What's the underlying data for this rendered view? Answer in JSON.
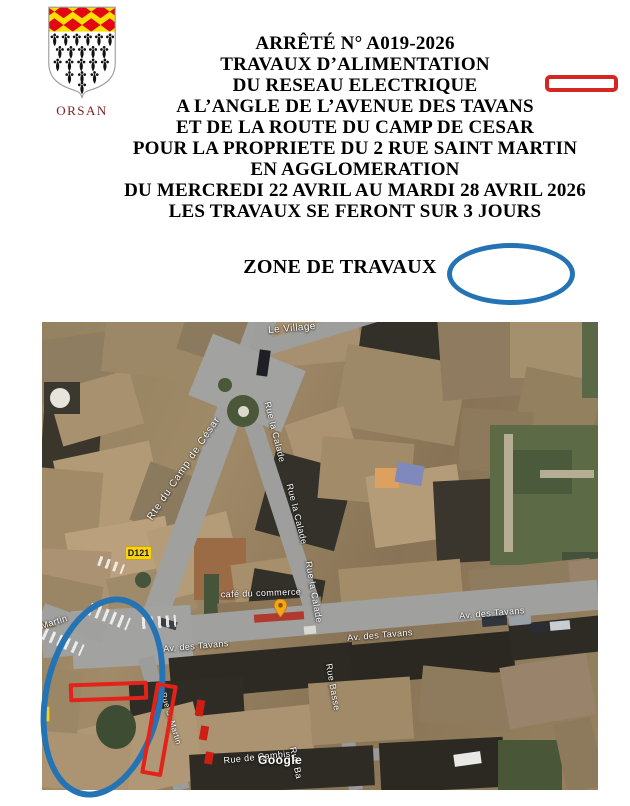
{
  "header": {
    "commune": "ORSAN",
    "title_lines": [
      "ARRÊTÉ N° A019-2026",
      "TRAVAUX D’ALIMENTATION",
      "DU RESEAU ELECTRIQUE",
      "A L’ANGLE DE L’AVENUE DES TAVANS",
      "ET DE LA ROUTE DU CAMP DE CESAR",
      "POUR LA PROPRIETE DU 2 RUE SAINT MARTIN",
      "EN AGGLOMERATION",
      "DU MERCREDI 22 AVRIL AU MARDI 28 AVRIL 2026",
      "LES TRAVAUX SE FERONT SUR 3 JOURS"
    ],
    "zone_label": "ZONE DE TRAVAUX"
  },
  "annotations": {
    "highlight_red": "#e32219",
    "highlight_blue": "#2473b5"
  },
  "map": {
    "road_badge": "D121",
    "attribution": "Google",
    "poi": {
      "name": "café du commerce",
      "pin_color": "#f7a61c"
    },
    "streets": {
      "le_village": "Le Village",
      "camp_de_cesar": "Rte du Camp de César",
      "calade": "Rue la Calade",
      "tavans": "Av. des Tavans",
      "basse": "Rue Basse",
      "basse_short": "Rue Ba",
      "cambis": "Rue de Cambis",
      "martin_partial": "Martin",
      "martin_street": "Rue St Martin"
    }
  }
}
